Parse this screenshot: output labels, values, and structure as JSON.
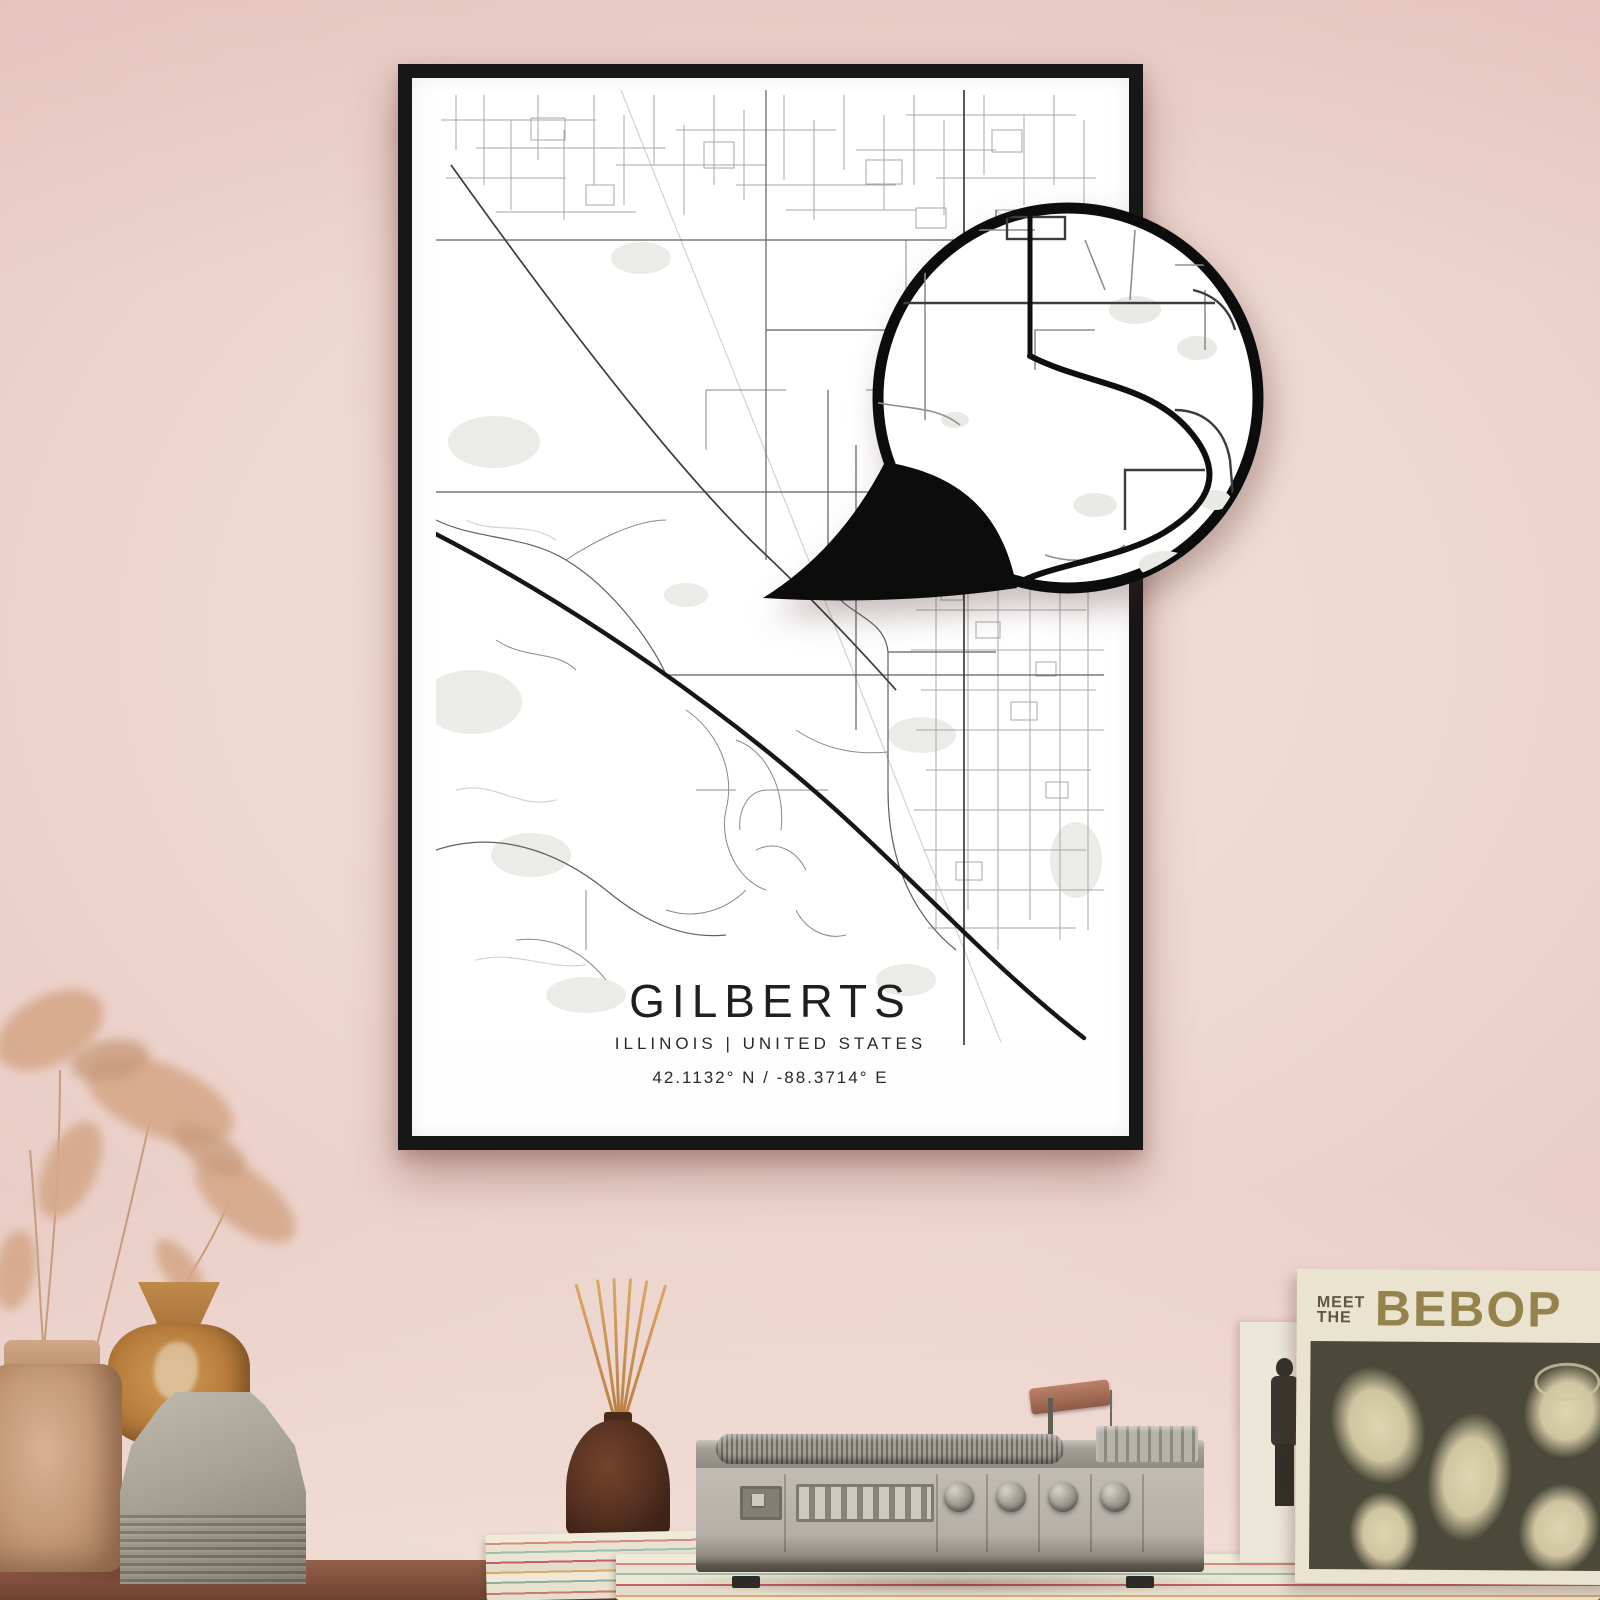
{
  "scene": {
    "wall_color": "#ecd4cd",
    "table_color": "#84523f"
  },
  "poster": {
    "title": "GILBERTS",
    "subtitle": "ILLINOIS | UNITED STATES",
    "coordinates": "42.1132° N / -88.3714° E",
    "frame_color": "#171717",
    "paper_color": "#fefefe",
    "map_ink_color": "#2a2a2a"
  },
  "zoom_badge": {
    "ring_color": "#0c0c0c"
  },
  "album": {
    "pretitle_top": "MEET",
    "pretitle_bottom": "THE",
    "title": "BEBOP",
    "title_color": "#95834e",
    "cover_color": "#4b493a",
    "sleeve_color": "#e9e3d0"
  }
}
